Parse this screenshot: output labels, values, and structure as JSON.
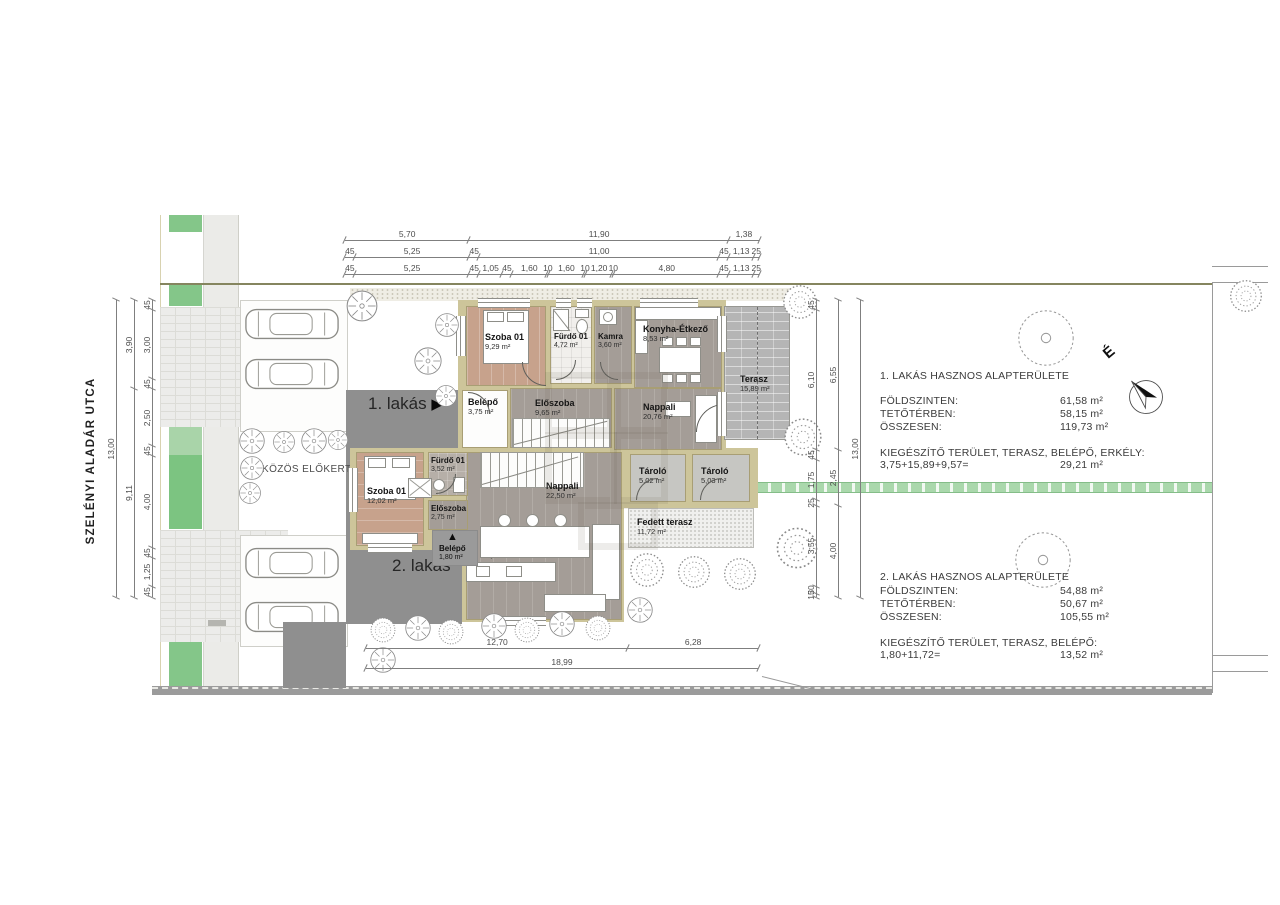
{
  "street": {
    "name": "SZELÉNYI ALADÁR UTCA"
  },
  "front_garden": {
    "label": "KÖZÖS ELŐKERT"
  },
  "labels": {
    "apt1": "1. lakás",
    "apt1_arrow": "▶",
    "apt2": "2. lakás",
    "north": "É",
    "belepo2_arrow": "▲"
  },
  "apartment1": {
    "rooms": [
      {
        "name": "Szoba 01",
        "area": "9,29 m²"
      },
      {
        "name": "Fürdő 01",
        "area": "4,72 m²"
      },
      {
        "name": "Kamra",
        "area": "3,60 m²"
      },
      {
        "name": "Konyha-Étkező",
        "area": "8,53 m²"
      },
      {
        "name": "Terasz",
        "area": "15,89 m²"
      },
      {
        "name": "Belépő",
        "area": "3,75 m²"
      },
      {
        "name": "Előszoba",
        "area": "9,65 m²"
      },
      {
        "name": "Nappali",
        "area": "20,76 m²"
      }
    ]
  },
  "apartment2": {
    "rooms": [
      {
        "name": "Szoba 01",
        "area": "12,02 m²"
      },
      {
        "name": "Fürdő 01",
        "area": "3,52 m²"
      },
      {
        "name": "Előszoba",
        "area": "2,75 m²"
      },
      {
        "name": "Belépő",
        "area": "1,80 m²"
      },
      {
        "name": "Nappali",
        "area": "22,50 m²"
      },
      {
        "name": "Konyha-Étkező",
        "area": "9,07 m²"
      },
      {
        "name": "Tároló",
        "area": "5,02 m²"
      },
      {
        "name": "Tároló",
        "area": "5,03 m²"
      },
      {
        "name": "Fedett terasz",
        "area": "11,72 m²"
      }
    ]
  },
  "summary1": {
    "title": "1. LAKÁS HASZNOS ALAPTERÜLETE",
    "rows": [
      {
        "label": "FÖLDSZINTEN:",
        "value": "61,58 m²"
      },
      {
        "label": "TETŐTÉRBEN:",
        "value": "58,15 m²"
      },
      {
        "label": "ÖSSZESEN:",
        "value": "119,73 m²"
      }
    ],
    "extra_title": "KIEGÉSZÍTŐ TERÜLET, TERASZ, BELÉPŐ, ERKÉLY:",
    "extra_calc": "3,75+15,89+9,57=",
    "extra_value": "29,21 m²"
  },
  "summary2": {
    "title": "2. LAKÁS HASZNOS ALAPTERÜLETE",
    "rows": [
      {
        "label": "FÖLDSZINTEN:",
        "value": "54,88 m²"
      },
      {
        "label": "TETŐTÉRBEN:",
        "value": "50,67 m²"
      },
      {
        "label": "ÖSSZESEN:",
        "value": "105,55 m²"
      }
    ],
    "extra_title": "KIEGÉSZÍTŐ TERÜLET, TERASZ, BELÉPŐ:",
    "extra_calc": "1,80+11,72=",
    "extra_value": "13,52 m²"
  },
  "dims": {
    "top1": [
      {
        "v": "5,70",
        "g": 5.7
      },
      {
        "v": "11,90",
        "g": 11.9
      },
      {
        "v": "1,38",
        "g": 1.38
      }
    ],
    "top2": [
      {
        "v": "45",
        "g": 0.45
      },
      {
        "v": "5,25",
        "g": 5.25
      },
      {
        "v": "45",
        "g": 0.45
      },
      {
        "v": "11,00",
        "g": 11
      },
      {
        "v": "45",
        "g": 0.45
      },
      {
        "v": "1,13",
        "g": 1.13
      },
      {
        "v": "25",
        "g": 0.25
      }
    ],
    "top3": [
      {
        "v": "45",
        "g": 0.45
      },
      {
        "v": "5,25",
        "g": 5.25
      },
      {
        "v": "45",
        "g": 0.45
      },
      {
        "v": "1,05",
        "g": 1.05
      },
      {
        "v": "45",
        "g": 0.45
      },
      {
        "v": "1,60",
        "g": 1.6
      },
      {
        "v": "10",
        "g": 0.1
      },
      {
        "v": "1,60",
        "g": 1.6
      },
      {
        "v": "10",
        "g": 0.1
      },
      {
        "v": "1,20",
        "g": 1.2
      },
      {
        "v": "10",
        "g": 0.1
      },
      {
        "v": "4,80",
        "g": 4.8
      },
      {
        "v": "45",
        "g": 0.45
      },
      {
        "v": "1,13",
        "g": 1.13
      },
      {
        "v": "25",
        "g": 0.25
      }
    ],
    "left_outer": [
      {
        "v": "13,00",
        "g": 13
      }
    ],
    "left_mid": [
      {
        "v": "3,90",
        "g": 3.9
      },
      {
        "v": "9,11",
        "g": 9.11
      }
    ],
    "left_inner": [
      {
        "v": "45",
        "g": 0.45
      },
      {
        "v": "3,00",
        "g": 3
      },
      {
        "v": "45",
        "g": 0.45
      },
      {
        "v": "2,50",
        "g": 2.5
      },
      {
        "v": "45",
        "g": 0.45
      },
      {
        "v": "4,00",
        "g": 4
      },
      {
        "v": "45",
        "g": 0.45
      },
      {
        "v": "1,25",
        "g": 1.25
      },
      {
        "v": "45",
        "g": 0.45
      }
    ],
    "right_inner": [
      {
        "v": "45",
        "g": 0.45
      },
      {
        "v": "6,10",
        "g": 6.1
      },
      {
        "v": "45",
        "g": 0.45
      },
      {
        "v": "1,75",
        "g": 1.75
      },
      {
        "v": "25",
        "g": 0.25
      },
      {
        "v": "3,55",
        "g": 3.55
      },
      {
        "v": "30",
        "g": 0.3
      },
      {
        "v": "15",
        "g": 0.15
      }
    ],
    "right_mid": [
      {
        "v": "6,55",
        "g": 6.55
      },
      {
        "v": "2,45",
        "g": 2.45
      },
      {
        "v": "4,00",
        "g": 4
      }
    ],
    "right_outer": [
      {
        "v": "13,00",
        "g": 13
      }
    ],
    "bottom1": [
      {
        "v": "12,70",
        "g": 12.7
      },
      {
        "v": "6,28",
        "g": 6.28
      }
    ],
    "bottom2": [
      {
        "v": "18,99",
        "g": 18.99
      }
    ]
  },
  "colors": {
    "wall_tan": "#cdc59a",
    "grass_green": "#7cc481",
    "utility_strip_green": "#aad8ac",
    "plaza_gray": "#8f8f8f",
    "terrace_gray": "#b5b5b5",
    "bedroom_floor": "#c7a28c",
    "living_floor": "#a49d97"
  }
}
